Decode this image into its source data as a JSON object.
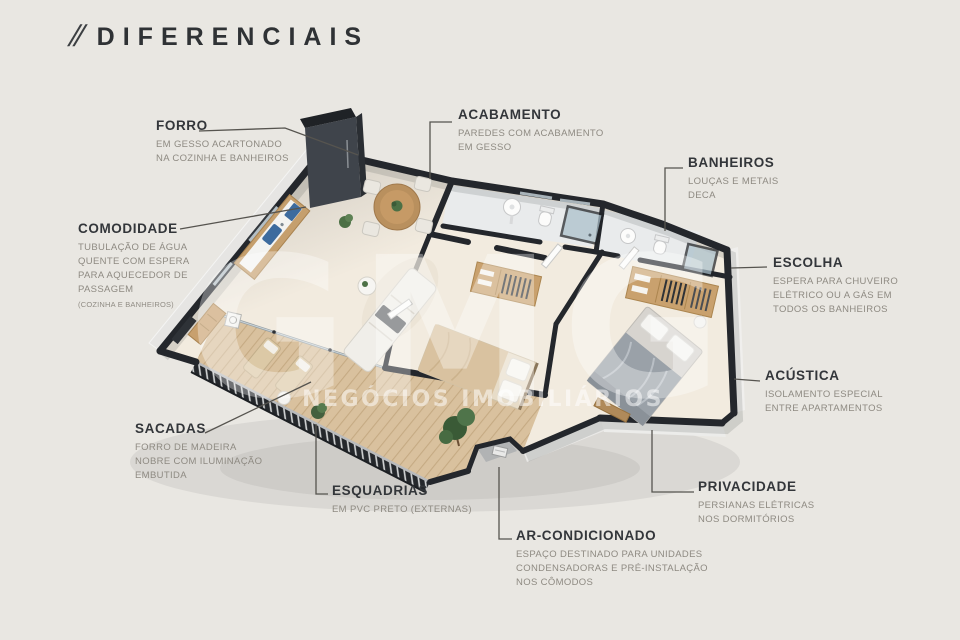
{
  "title": {
    "slashes": "//",
    "text": "DIFERENCIAIS"
  },
  "watermark": {
    "logo": "GMG",
    "subtitle": "NEGÓCIOS IMOBILIÁRIOS"
  },
  "colors": {
    "background": "#e9e7e2",
    "ink": "#2f3235",
    "muted_text": "#8e8a82",
    "wall": "#24272c",
    "floor": "#f2ebdf",
    "bath_floor": "#e9ebec",
    "wood": "#c9a16e",
    "table_wood": "#b9905e",
    "greenery": "#4c7045",
    "sink_blue": "#3d6b9e",
    "bed_tan": "#d9c2a0",
    "bed_gray": "#9aa1a8",
    "watermark_white": "rgba(255,255,255,0.38)"
  },
  "features": [
    {
      "id": "forro",
      "heading": "FORRO",
      "lines": [
        "EM GESSO ACARTONADO",
        "NA COZINHA E BANHEIROS"
      ]
    },
    {
      "id": "acabamento",
      "heading": "ACABAMENTO",
      "lines": [
        "PAREDES COM ACABAMENTO",
        "EM GESSO"
      ]
    },
    {
      "id": "banheiros",
      "heading": "BANHEIROS",
      "lines": [
        "LOUÇAS E METAIS",
        "DECA"
      ]
    },
    {
      "id": "comodidade",
      "heading": "COMODIDADE",
      "lines": [
        "TUBULAÇÃO DE ÁGUA",
        "QUENTE COM ESPERA",
        "PARA AQUECEDOR DE",
        "PASSAGEM"
      ],
      "note": "(COZINHA E BANHEIROS)"
    },
    {
      "id": "escolha",
      "heading": "ESCOLHA",
      "lines": [
        "ESPERA PARA CHUVEIRO",
        "ELÉTRICO OU A GÁS EM",
        "TODOS OS BANHEIROS"
      ]
    },
    {
      "id": "acustica",
      "heading": "ACÚSTICA",
      "lines": [
        "ISOLAMENTO ESPECIAL",
        "ENTRE APARTAMENTOS"
      ]
    },
    {
      "id": "sacadas",
      "heading": "SACADAS",
      "lines": [
        "FORRO DE MADEIRA",
        "NOBRE COM ILUMINAÇÃO",
        "EMBUTIDA"
      ]
    },
    {
      "id": "esquadrias",
      "heading": "ESQUADRIAS",
      "lines": [
        "EM PVC PRETO (EXTERNAS)"
      ]
    },
    {
      "id": "ar",
      "heading": "AR-CONDICIONADO",
      "lines": [
        "ESPAÇO DESTINADO PARA UNIDADES",
        "CONDENSADORAS E PRÉ-INSTALAÇÃO",
        "NOS CÔMODOS"
      ]
    },
    {
      "id": "privacidade",
      "heading": "PRIVACIDADE",
      "lines": [
        "PERSIANAS ELÉTRICAS",
        "NOS DORMITÓRIOS"
      ]
    }
  ]
}
